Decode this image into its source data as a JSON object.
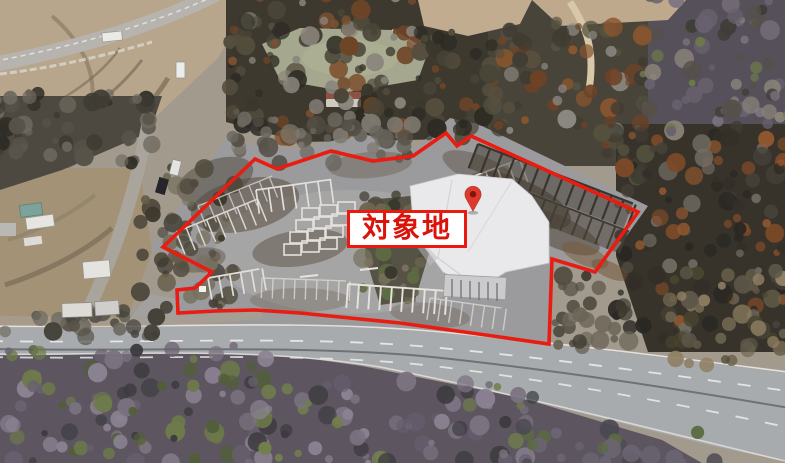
{
  "annotation": {
    "label_text": "対象地",
    "label_box": {
      "x": 347,
      "y": 210,
      "w": 120,
      "h": 38,
      "bg": "#ffffff",
      "border_color": "#ea1a10",
      "text_color": "#d9140b"
    },
    "boundary": {
      "color": "#ea1b10",
      "width": 3.6,
      "points": "163,247 255,159 277,169 331,151 373,161 413,156 446,133 457,146 471,136 638,212 595,272 552,259 549,344 500,337 450,330 400,323 350,318 300,313 255,310 215,311 178,313 177,290 195,288 212,272"
    },
    "marker": {
      "icon": "map-pin-icon",
      "x": 473,
      "y": 212,
      "fill": "#de392d",
      "hole_fill": "#7f150c"
    }
  }
}
